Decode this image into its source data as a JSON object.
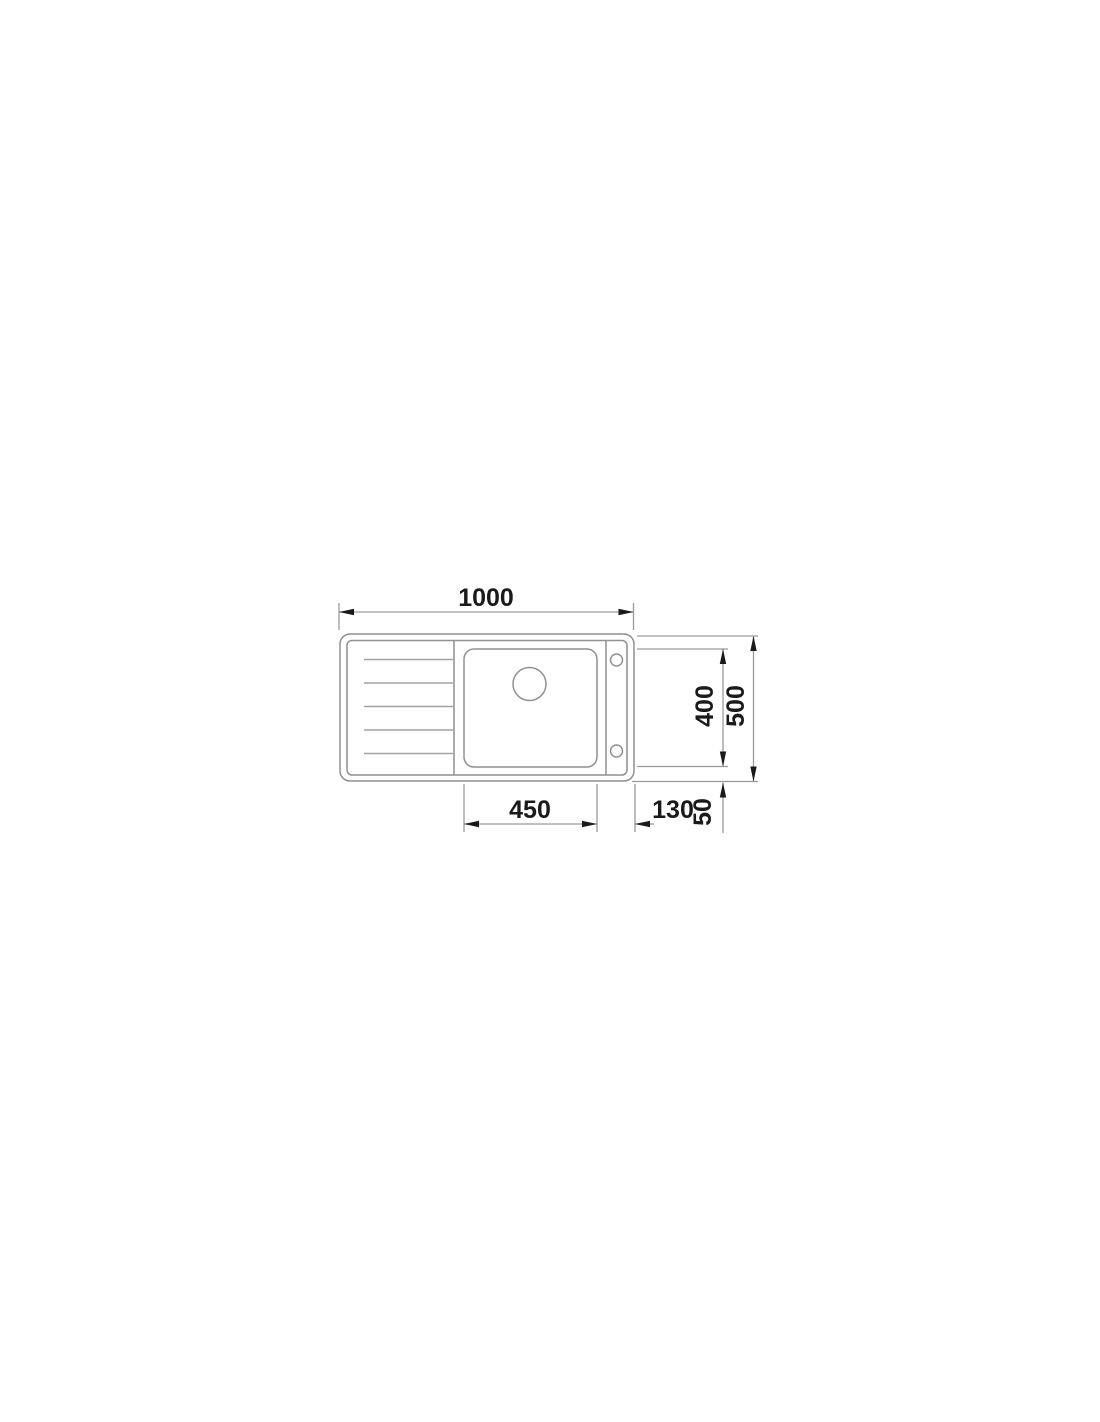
{
  "figure": {
    "type": "technical-drawing",
    "subject": "kitchen sink with drainboard, top view, dimensioned",
    "labels": {
      "overall_width": "1000",
      "bowl_width": "450",
      "bowl_right_offset": "130",
      "rim_offset": "50",
      "bowl_depth": "400",
      "overall_depth": "500"
    },
    "colors": {
      "background": "#ffffff",
      "outline": "#919191",
      "drainboard_line": "#a3a3a3",
      "dimension_line": "#9a9a9a",
      "annotation": "#1a1a1a"
    }
  }
}
